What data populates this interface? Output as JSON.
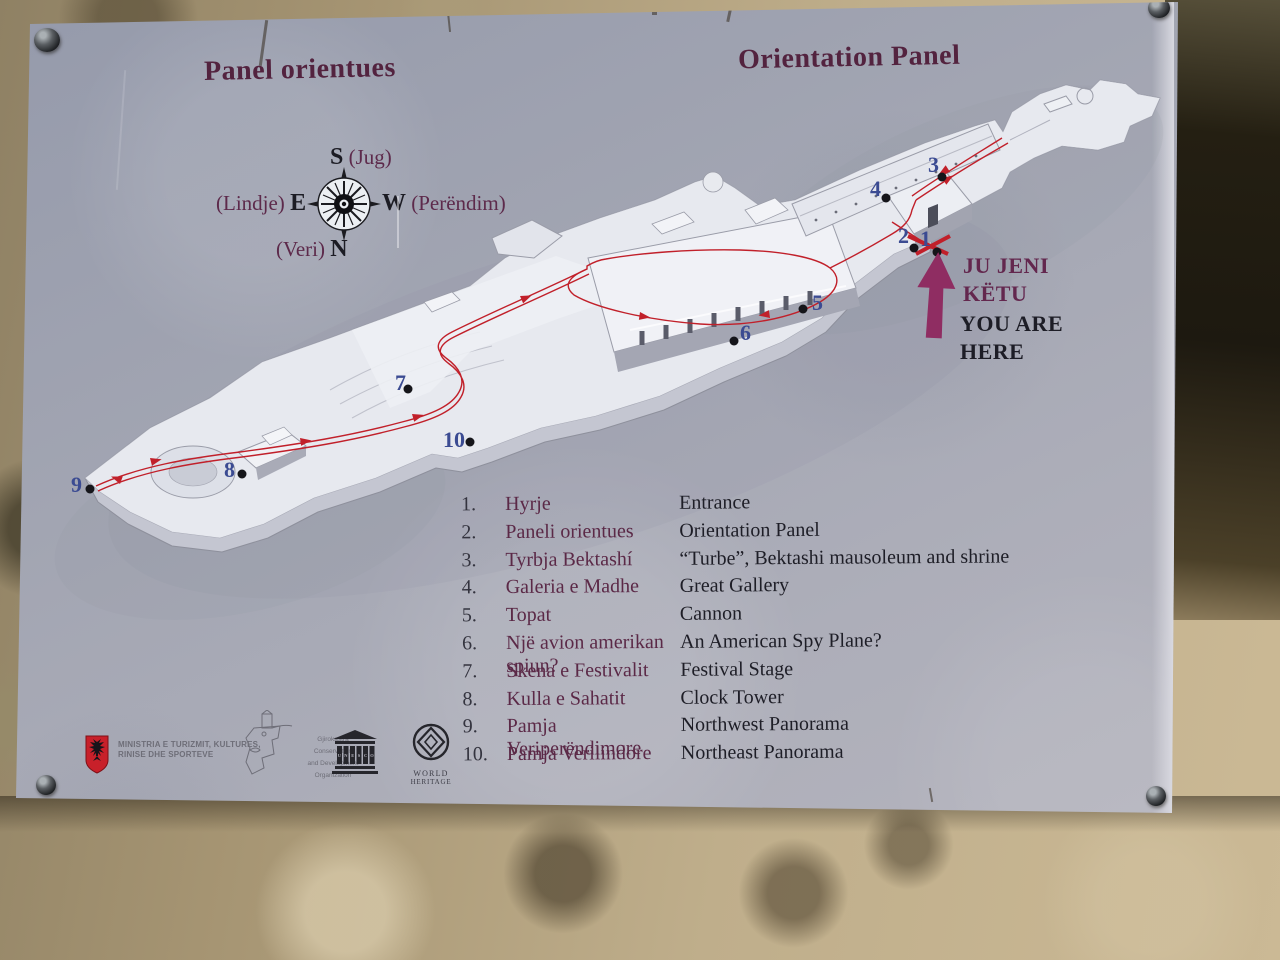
{
  "panel": {
    "title_sq": "Panel orientues",
    "title_en": "Orientation Panel"
  },
  "compass": {
    "s": "S",
    "s_sq": "(Jug)",
    "e": "E",
    "e_sq": "(Lindje)",
    "w": "W",
    "w_sq": "(Perëndim)",
    "n": "N",
    "n_sq": "(Veri)"
  },
  "you_are_here": {
    "sq_line1": "JU JENI",
    "sq_line2": "KËTU",
    "en_line1": "YOU ARE",
    "en_line2": "HERE"
  },
  "legend": {
    "items": [
      {
        "num": "1.",
        "sq": "Hyrje",
        "en": "Entrance"
      },
      {
        "num": "2.",
        "sq": "Paneli orientues",
        "en": "Orientation Panel"
      },
      {
        "num": "3.",
        "sq": "Tyrbja Bektashí",
        "en": "“Turbe”, Bektashi mausoleum and shrine"
      },
      {
        "num": "4.",
        "sq": "Galeria e Madhe",
        "en": "Great Gallery"
      },
      {
        "num": "5.",
        "sq": "Topat",
        "en": "Cannon"
      },
      {
        "num": "6.",
        "sq": "Një avion amerikan spiun?",
        "en": "An American Spy Plane?"
      },
      {
        "num": "7.",
        "sq": "Skena e Festivalit",
        "en": "Festival Stage"
      },
      {
        "num": "8.",
        "sq": "Kulla e Sahatit",
        "en": "Clock Tower"
      },
      {
        "num": "9.",
        "sq": "Pamja Veriperëndimore",
        "en": "Northwest Panorama"
      },
      {
        "num": "10.",
        "sq": "Pamja Verilindore",
        "en": "Northeast Panorama"
      }
    ]
  },
  "map": {
    "markers": [
      {
        "label": "1"
      },
      {
        "label": "2"
      },
      {
        "label": "3"
      },
      {
        "label": "4"
      },
      {
        "label": "5"
      },
      {
        "label": "6"
      },
      {
        "label": "7"
      },
      {
        "label": "8"
      },
      {
        "label": "9"
      },
      {
        "label": "10"
      }
    ]
  },
  "logos": {
    "ministry_line1": "MINISTRIA E TURIZMIT, KULTURES,",
    "ministry_line2": "RINISE DHE SPORTEVE",
    "gco_line1": "Gjirokastra Conservation",
    "gco_line2": "and Development",
    "gco_line3": "Organization",
    "unesco": "UNESCO",
    "wh_line1": "WORLD",
    "wh_line2": "HERITAGE"
  },
  "colors": {
    "title_maroon": "#53233f",
    "legend_albanian": "#5b2947",
    "legend_english": "#1e1e27",
    "marker_blue": "#3b4b92",
    "route_red": "#c1202a",
    "arrow_magenta": "#8f2d62",
    "panel_gray": "#a8aab5",
    "stone_tan": "#bfae8b",
    "flag_red": "#c8202a"
  }
}
